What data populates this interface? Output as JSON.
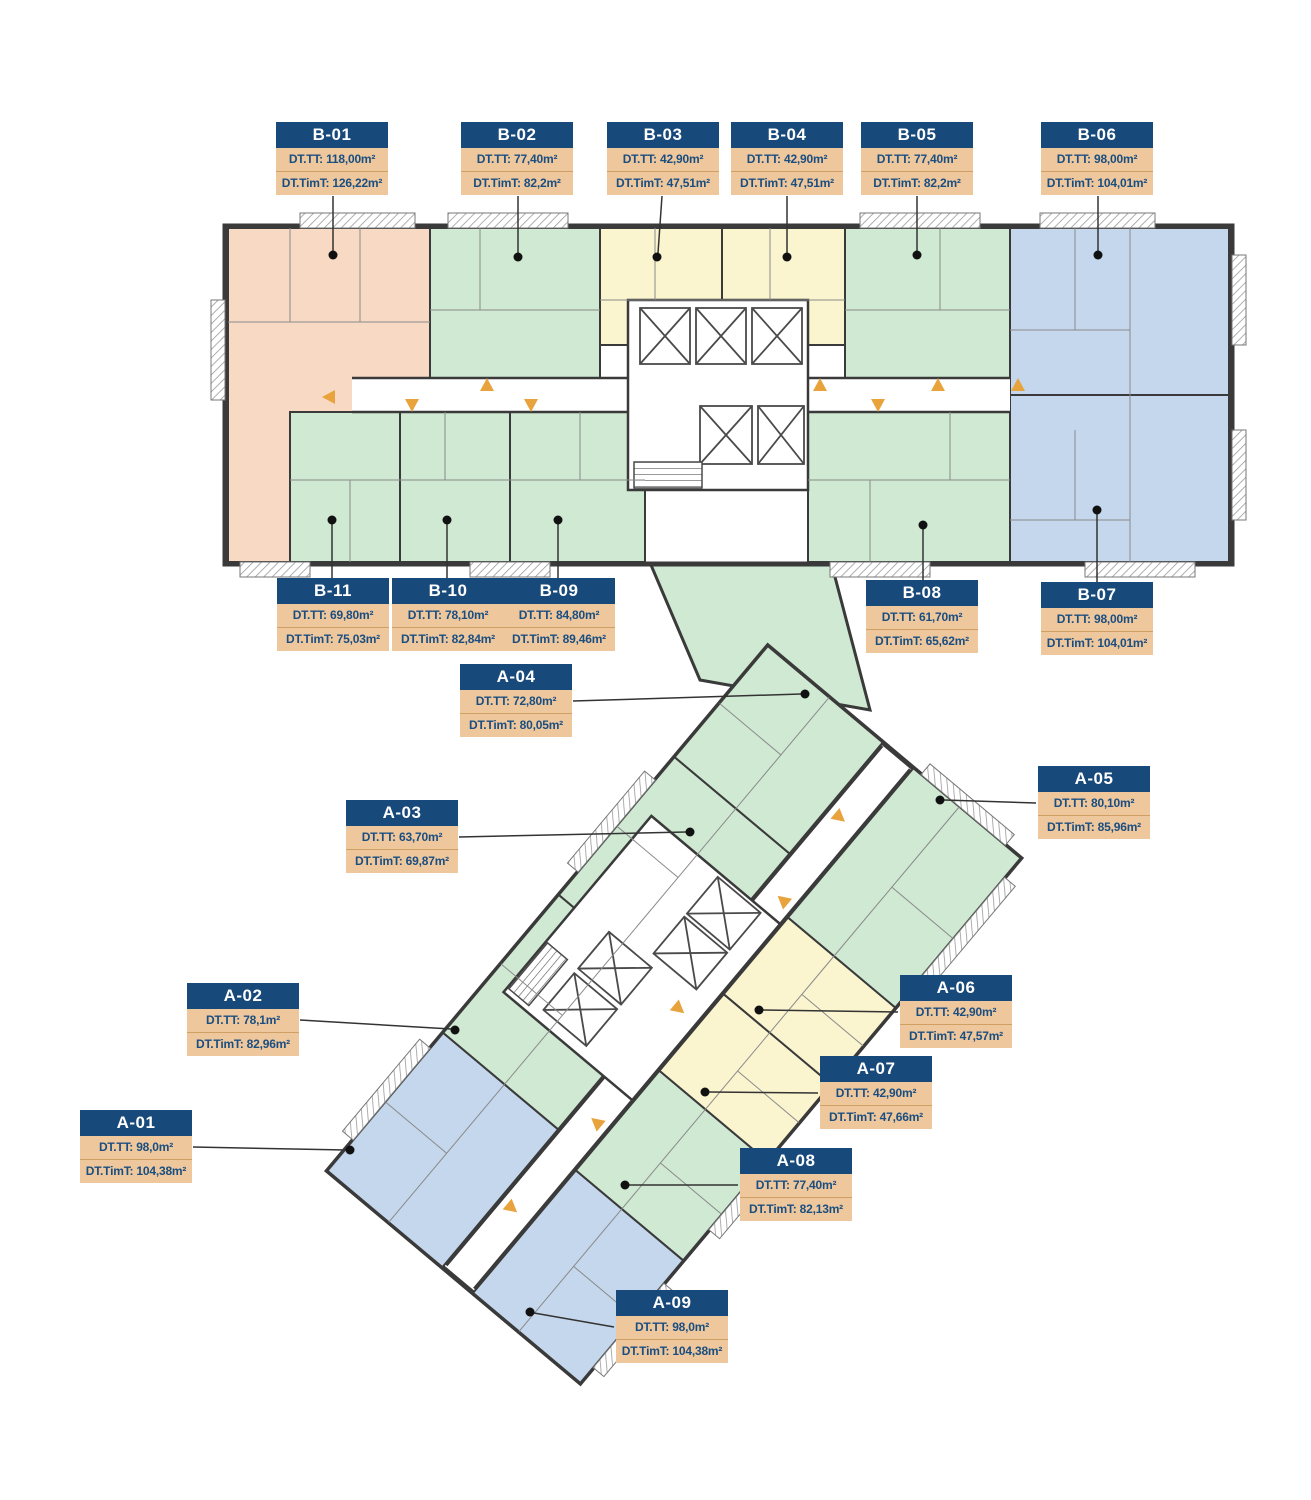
{
  "colors": {
    "label_header_bg": "#17497a",
    "label_body_bg": "#eec79d",
    "label_text": "#1a4e80",
    "unit_green": "#cfe9d3",
    "unit_yellow": "#faf4cf",
    "unit_blue": "#c4d7ec",
    "unit_salmon": "#f8d9c4",
    "wall": "#3a3a3a",
    "arrow": "#e8a33d",
    "leader": "#333333"
  },
  "units": [
    {
      "id": "B-01",
      "tt": "DT.TT: 118,00m²",
      "tim": "DT.TimT: 126,22m²",
      "color": "salmon"
    },
    {
      "id": "B-02",
      "tt": "DT.TT: 77,40m²",
      "tim": "DT.TimT: 82,2m²",
      "color": "green"
    },
    {
      "id": "B-03",
      "tt": "DT.TT: 42,90m²",
      "tim": "DT.TimT: 47,51m²",
      "color": "yellow"
    },
    {
      "id": "B-04",
      "tt": "DT.TT: 42,90m²",
      "tim": "DT.TimT: 47,51m²",
      "color": "yellow"
    },
    {
      "id": "B-05",
      "tt": "DT.TT: 77,40m²",
      "tim": "DT.TimT: 82,2m²",
      "color": "green"
    },
    {
      "id": "B-06",
      "tt": "DT.TT: 98,00m²",
      "tim": "DT.TimT: 104,01m²",
      "color": "blue"
    },
    {
      "id": "B-07",
      "tt": "DT.TT: 98,00m²",
      "tim": "DT.TimT: 104,01m²",
      "color": "blue"
    },
    {
      "id": "B-08",
      "tt": "DT.TT: 61,70m²",
      "tim": "DT.TimT: 65,62m²",
      "color": "green"
    },
    {
      "id": "B-09",
      "tt": "DT.TT: 84,80m²",
      "tim": "DT.TimT: 89,46m²",
      "color": "green"
    },
    {
      "id": "B-10",
      "tt": "DT.TT: 78,10m²",
      "tim": "DT.TimT: 82,84m²",
      "color": "green"
    },
    {
      "id": "B-11",
      "tt": "DT.TT: 69,80m²",
      "tim": "DT.TimT: 75,03m²",
      "color": "green"
    },
    {
      "id": "A-01",
      "tt": "DT.TT: 98,0m²",
      "tim": "DT.TimT: 104,38m²",
      "color": "blue"
    },
    {
      "id": "A-02",
      "tt": "DT.TT: 78,1m²",
      "tim": "DT.TimT: 82,96m²",
      "color": "green"
    },
    {
      "id": "A-03",
      "tt": "DT.TT: 63,70m²",
      "tim": "DT.TimT: 69,87m²",
      "color": "green"
    },
    {
      "id": "A-04",
      "tt": "DT.TT: 72,80m²",
      "tim": "DT.TimT: 80,05m²",
      "color": "green"
    },
    {
      "id": "A-05",
      "tt": "DT.TT: 80,10m²",
      "tim": "DT.TimT: 85,96m²",
      "color": "green"
    },
    {
      "id": "A-06",
      "tt": "DT.TT: 42,90m²",
      "tim": "DT.TimT: 47,57m²",
      "color": "yellow"
    },
    {
      "id": "A-07",
      "tt": "DT.TT: 42,90m²",
      "tim": "DT.TimT: 47,66m²",
      "color": "yellow"
    },
    {
      "id": "A-08",
      "tt": "DT.TT: 77,40m²",
      "tim": "DT.TimT: 82,13m²",
      "color": "green"
    },
    {
      "id": "A-09",
      "tt": "DT.TT: 98,0m²",
      "tim": "DT.TimT: 104,38m²",
      "color": "blue"
    }
  ]
}
